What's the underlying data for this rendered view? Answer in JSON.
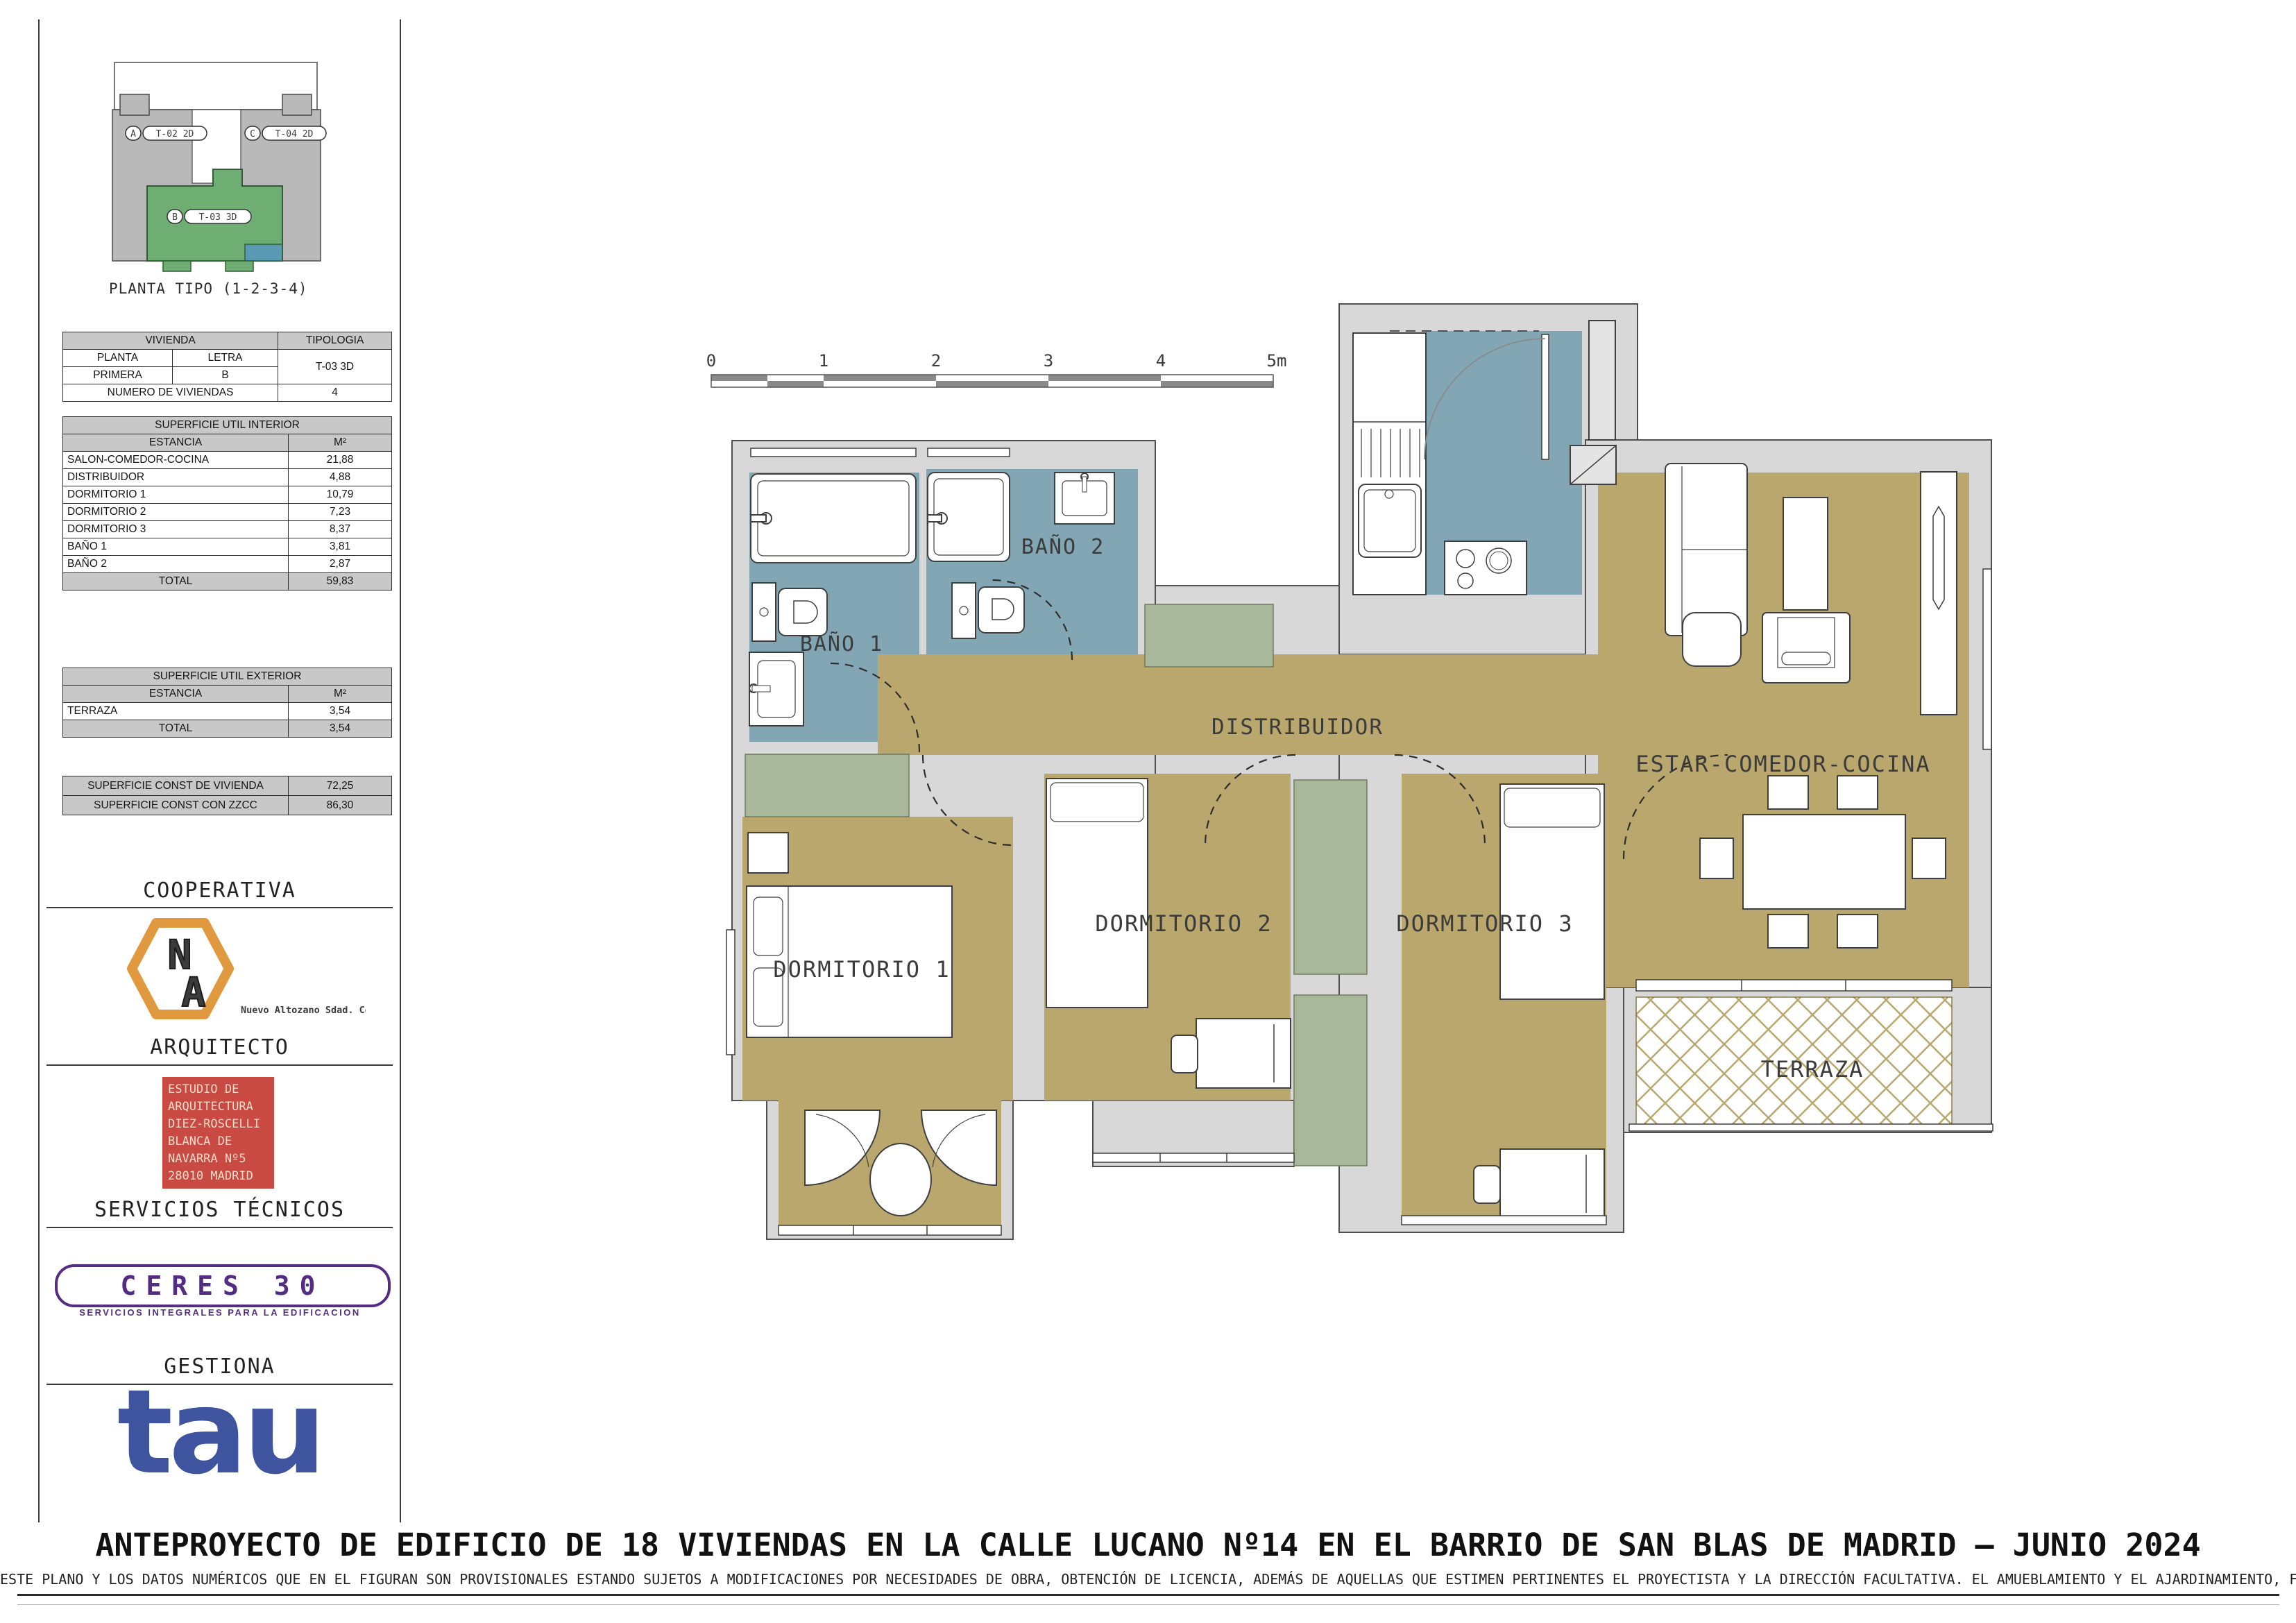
{
  "palette": {
    "room_floor": "#b9a76d",
    "wet_floor": "#82a6b3",
    "closet_floor": "#a9b79b",
    "wall_gray": "#d8d8d8",
    "keyplan_gray": "#b9b9b9",
    "keyplan_green": "#6fae72",
    "keyplan_blue": "#5b9ab5",
    "na_orange": "#e0993e",
    "na_red": "#c44536",
    "na_blue": "#3d9bc4",
    "arch_red": "#c94a43",
    "ceres_purple": "#542c84",
    "tau_blue": "#3e549f"
  },
  "keyplan": {
    "caption": "PLANTA TIPO (1-2-3-4)",
    "units": [
      {
        "badge": "A",
        "code": "T-02 2D"
      },
      {
        "badge": "C",
        "code": "T-04 2D"
      },
      {
        "badge": "B",
        "code": "T-03 3D"
      }
    ]
  },
  "tables": {
    "vivienda": {
      "title": "VIVIENDA",
      "tipologia_title": "TIPOLOGIA",
      "planta_label": "PLANTA",
      "letra_label": "LETRA",
      "planta": "PRIMERA",
      "letra": "B",
      "tipologia": "T-03 3D",
      "num_label": "NUMERO DE VIVIENDAS",
      "num": "4"
    },
    "interior": {
      "title": "SUPERFICIE UTIL INTERIOR",
      "estancia": "ESTANCIA",
      "m2": "M²",
      "rows": [
        {
          "name": "SALON-COMEDOR-COCINA",
          "m2": "21,88"
        },
        {
          "name": "DISTRIBUIDOR",
          "m2": "4,88"
        },
        {
          "name": "DORMITORIO 1",
          "m2": "10,79"
        },
        {
          "name": "DORMITORIO 2",
          "m2": "7,23"
        },
        {
          "name": "DORMITORIO 3",
          "m2": "8,37"
        },
        {
          "name": "BAÑO 1",
          "m2": "3,81"
        },
        {
          "name": "BAÑO 2",
          "m2": "2,87"
        }
      ],
      "total_label": "TOTAL",
      "total": "59,83"
    },
    "exterior": {
      "title": "SUPERFICIE UTIL EXTERIOR",
      "estancia": "ESTANCIA",
      "m2": "M²",
      "rows": [
        {
          "name": "TERRAZA",
          "m2": "3,54"
        }
      ],
      "total_label": "TOTAL",
      "total": "3,54"
    },
    "construida": {
      "rows": [
        {
          "name": "SUPERFICIE CONST DE VIVIENDA",
          "m2": "72,25"
        },
        {
          "name": "SUPERFICIE CONST CON ZZCC",
          "m2": "86,30"
        }
      ]
    }
  },
  "sections": {
    "cooperativa": "COOPERATIVA",
    "arquitecto": "ARQUITECTO",
    "servicios": "SERVICIOS TÉCNICOS",
    "gestiona": "GESTIONA"
  },
  "logos": {
    "na": {
      "n": "N",
      "a": "A",
      "sub": "Nuevo Altozano Sdad. Coop."
    },
    "arch_box": [
      "ESTUDIO DE",
      "ARQUITECTURA",
      "DIEZ-ROSCELLI",
      "BLANCA DE",
      "NAVARRA Nº5",
      "28010 MADRID"
    ],
    "ceres": {
      "text": "CERES 30",
      "sub": "SERVICIOS INTEGRALES PARA LA EDIFICACION"
    },
    "tau": "tau"
  },
  "plan": {
    "scale": [
      "0",
      "1",
      "2",
      "3",
      "4",
      "5m"
    ],
    "rooms": {
      "bano1": "BAÑO 1",
      "bano2": "BAÑO 2",
      "distribuidor": "DISTRIBUIDOR",
      "estar": "ESTAR-COMEDOR-COCINA",
      "dorm1": "DORMITORIO 1",
      "dorm2": "DORMITORIO 2",
      "dorm3": "DORMITORIO 3",
      "terraza": "TERRAZA"
    }
  },
  "footer": {
    "title": "ANTEPROYECTO DE EDIFICIO DE 18 VIVIENDAS EN LA CALLE LUCANO Nº14 EN EL BARRIO DE SAN BLAS DE MADRID – JUNIO 2024",
    "disclaimer": "ESTE PLANO Y LOS DATOS NUMÉRICOS QUE EN EL FIGURAN SON PROVISIONALES ESTANDO SUJETOS A MODIFICACIONES POR NECESIDADES DE OBRA, OBTENCIÓN DE LICENCIA, ADEMÁS DE AQUELLAS QUE ESTIMEN PERTINENTES EL PROYECTISTA Y LA DIRECCIÓN FACULTATIVA. EL AMUEBLAMIENTO Y EL AJARDINAMIENTO, FIGURAN EXCLUSIVAMENTE A TÍTULO ORIENTATIVO NO ESTANDO INCLUIDO EN EL COSTE DE LA VIVIENDA"
  }
}
